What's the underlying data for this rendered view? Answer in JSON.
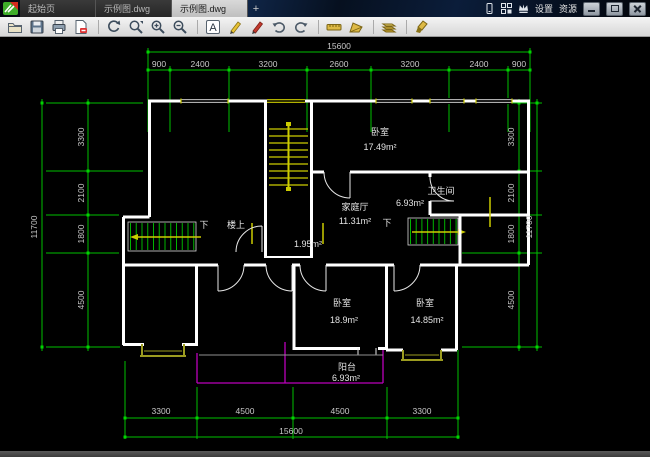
{
  "window": {
    "tabs": [
      {
        "label": "起始页"
      },
      {
        "label": "示例图.dwg"
      },
      {
        "label": "示例图.dwg"
      }
    ],
    "active_tab_index": 2,
    "new_tab_label": "+",
    "settings_label": "设置",
    "resources_label": "资源"
  },
  "toolbar": {
    "text_tool_glyph": "A",
    "icons": [
      "open",
      "save",
      "print",
      "export-pdf",
      "rotate-view",
      "zoom-extents",
      "zoom-in",
      "zoom-out",
      "text-annotate",
      "pencil-annotate",
      "marker-annotate",
      "undo",
      "redo",
      "measure-length",
      "measure-area",
      "layers",
      "cleanup"
    ]
  },
  "plan": {
    "dims": {
      "top_total": "15600",
      "top_segments": [
        "900",
        "2400",
        "3200",
        "2600",
        "3200",
        "2400",
        "900"
      ],
      "left_total": "11700",
      "left_segments": [
        "3300",
        "2100",
        "1800",
        "4500"
      ],
      "right_segments": [
        "3300",
        "2100",
        "1800",
        "4500"
      ],
      "right_total": "11700",
      "bottom_segments": [
        "3300",
        "4500",
        "4500",
        "3300"
      ],
      "bottom_total": "15600"
    },
    "rooms": {
      "bedroom_top": {
        "name": "卧室",
        "area": "17.49m²"
      },
      "bathroom": {
        "name": "卫生间",
        "area": "6.93m²"
      },
      "family_hall": {
        "name": "家庭厅",
        "area": "11.31m²"
      },
      "under_stair": {
        "area": "1.95m²"
      },
      "stair_down_left": "下",
      "stair_up_left": "楼上",
      "stair_down_right": "下",
      "bedroom_left": {
        "name": "卧室",
        "area": "18.9m²"
      },
      "bedroom_right": {
        "name": "卧室",
        "area": "14.85m²"
      },
      "balcony": {
        "name": "阳台",
        "area": "6.93m²"
      }
    },
    "colors": {
      "dimension": "#00c000",
      "wall": "#ffffff",
      "stair": "#cccc00",
      "balcony": "#bb00bb",
      "bay_window": "#9c9c20"
    }
  }
}
